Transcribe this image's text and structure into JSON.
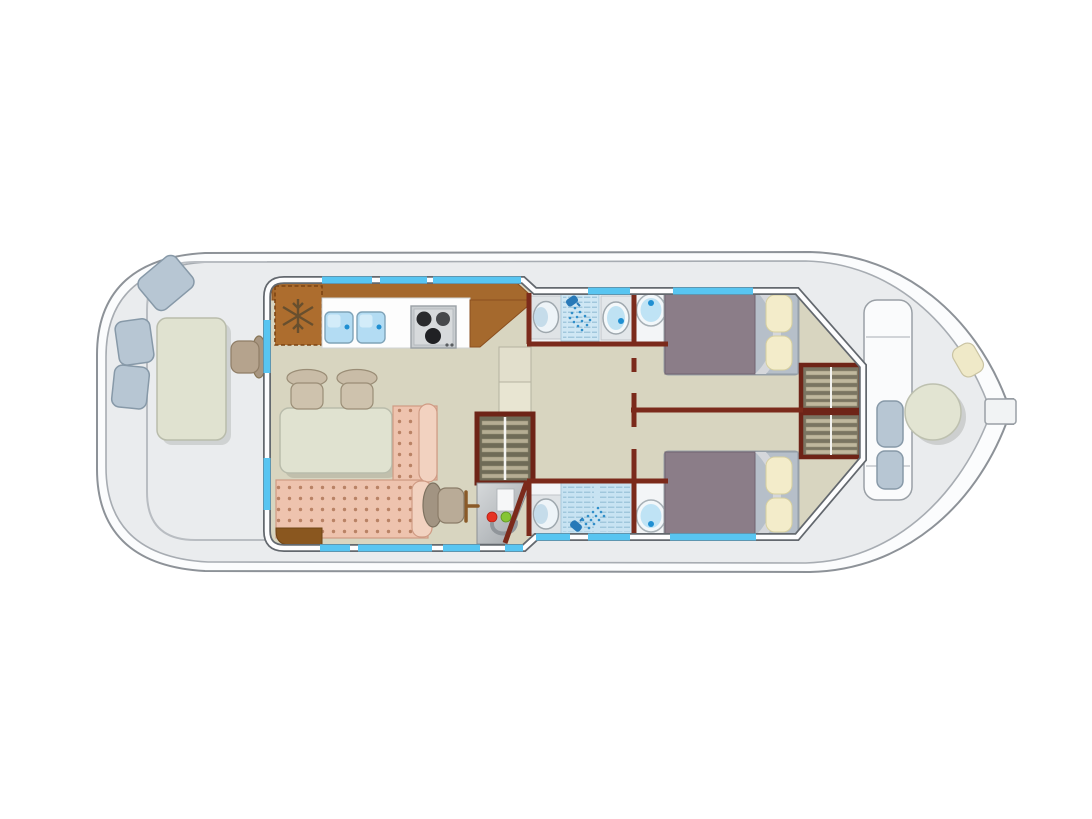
{
  "diagram": {
    "type": "boat-floor-plan",
    "subject": "canal houseboat deck plan, top view, bow at left and stern at right",
    "text_labels": []
  },
  "palette": {
    "background": "#ffffff",
    "hull_fill": "#fbfcfd",
    "hull_outline": "#8d9298",
    "deck": "#eaecee",
    "inner_line": "#a7acb2",
    "railing": "#b9bdc2",
    "cabin_floor": "#d8d5c0",
    "wall_dark": "#63686e",
    "wall_core": "#fdfdfe",
    "partition": "#7b2a1b",
    "window": "#58c5f1",
    "counter": "#a5692d",
    "counter_edge": "#8a4e1e",
    "fridge": "#ad6d2e",
    "snowflake": "#5c4a2e",
    "sink": "#b3dcf3",
    "water_dot": "#1f8fd2",
    "stove_body": "#c9cdd0",
    "burner": "#232427",
    "table": "#e0e2d0",
    "table_edge": "#b9bcab",
    "seat_blue": "#b7c6d3",
    "seat_blue_edge": "#8799a8",
    "chair_tan": "#cec2ad",
    "chair_edge": "#9a8d76",
    "stool": "#b5a38d",
    "sofa": "#eec3ae",
    "sofa_dot": "#b98265",
    "sofa_edge": "#cf9b84",
    "armrest": "#f2d2c0",
    "wedge_brown": "#8a571f",
    "bath_floor": "#f3f5f7",
    "fixture_panel": "#dfe3e6",
    "fixture_rim": "#9fa8ae",
    "basin_water": "#bfe2f3",
    "shower_panel": "#cfe7f4",
    "shower_lines": "#9cc4da",
    "shower_head": "#2779b8",
    "duvet": "#8b7d88",
    "sheet_fold": "#d5d7db",
    "pillow_panel": "#b6bfc9",
    "pillow": "#f3ecca",
    "wardrobe_bg": "#7a7562",
    "wardrobe_slat": "#c0b89e",
    "wardrobe_frame": "#6e2417",
    "stairs_bg": "#6f6b57",
    "stairs_slat": "#b5ad93",
    "panel_light": "#d6d9db",
    "panel_dark": "#9ea3a7",
    "indicator_red": "#e63222",
    "indicator_green": "#86c534",
    "door_handle": "#8a5a28",
    "cream_cushion": "#efe9c8"
  },
  "areas": [
    {
      "name": "bow-deck",
      "items": [
        "rectangular-table",
        "seat",
        "seat",
        "seat",
        "stool"
      ]
    },
    {
      "name": "galley",
      "items": [
        "fridge-with-snowflake",
        "sink",
        "sink",
        "stove-3-burner",
        "worktop"
      ]
    },
    {
      "name": "saloon",
      "items": [
        "dining-table",
        "chair",
        "chair",
        "l-shaped-sofa",
        "helm-chair",
        "electrical-panel",
        "companionway-stairs",
        "entry-steps",
        "door-handle"
      ]
    },
    {
      "name": "shower-room-forward",
      "items": [
        "washbasin",
        "shower",
        "washbasin",
        "toilet"
      ]
    },
    {
      "name": "shower-room-aft",
      "items": [
        "washbasin",
        "shower",
        "toilet"
      ]
    },
    {
      "name": "cabin-forward",
      "items": [
        "double-bed",
        "pillow",
        "pillow",
        "wardrobe"
      ]
    },
    {
      "name": "cabin-aft",
      "items": [
        "double-bed",
        "pillow",
        "pillow",
        "wardrobe"
      ]
    },
    {
      "name": "stern-deck",
      "items": [
        "round-table",
        "seat",
        "seat",
        "cushion",
        "tiller"
      ]
    }
  ],
  "counts": {
    "windows": 12,
    "beds": 2,
    "toilets": 2,
    "showers": 2,
    "washbasins": 3,
    "sinks": 2,
    "wardrobe-sections": 2
  }
}
